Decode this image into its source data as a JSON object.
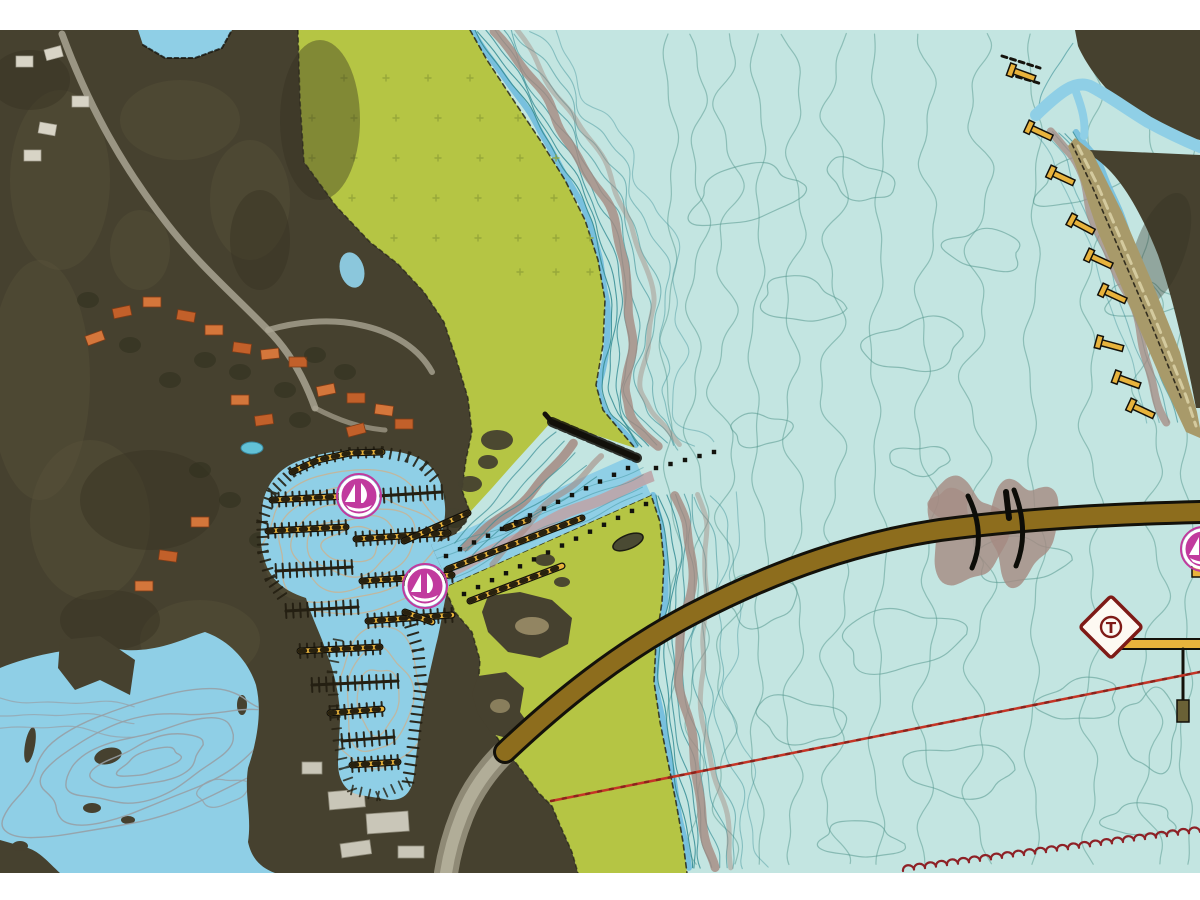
{
  "title": "Marine chart with satellite imagery overlay (marina, channel, bridge and depth contours)",
  "palette": {
    "page_bg": "#ffffff",
    "sat_land": "#46412f",
    "sat_land_light": "#5b553d",
    "sat_land_dark": "#353021",
    "chart_land_green": "#b5c544",
    "land_dot": "#93a238",
    "water_open": "#c3e5e1",
    "water_shallow": "#8fcfe6",
    "water_edge_blue": "#74bedd",
    "contour_teal": "#3a8f96",
    "contour_open": "#55988e",
    "contour_gray": "#97a0a6",
    "contour_tan": "#c3b59b",
    "shoal_mauve": "#a58981",
    "dredge_mauve": "#bca4a8",
    "dock_black": "#241f12",
    "pier_yellow": "#e8b33c",
    "bridge_brown": "#8d6d1d",
    "bridge_outline": "#13110a",
    "beach_tan": "#a89a6a",
    "marina_magenta": "#c13a9e",
    "icon_white": "#ffffff",
    "tower_red": "#7e1a16",
    "hazard_red": "#c53526",
    "cable_dark_red": "#8e2126",
    "road_gray": "#a9a492",
    "roof_orange": "#c2602a",
    "building_white": "#d8d4c6"
  },
  "symbols": {
    "tower_label": "T",
    "marina_facility_icons": 3,
    "legend": [
      {
        "name": "marina-sailboat-icon",
        "meaning": "marina / yacht basin facility"
      },
      {
        "name": "tower-beacon-marker",
        "meaning": "beacon daymark (T)"
      },
      {
        "name": "submarine-cable-line",
        "meaning": "overhead/submarine cable"
      },
      {
        "name": "hazard-boundary-line",
        "meaning": "restricted area / cable boundary"
      },
      {
        "name": "pile-markers",
        "meaning": "dotted pile rows along dredged channel"
      },
      {
        "name": "pier-symbols",
        "meaning": "piers and docks (yellow)"
      },
      {
        "name": "bridge-causeway",
        "meaning": "fixed bridge / causeway"
      },
      {
        "name": "depth-contours",
        "meaning": "bathymetric contour lines"
      }
    ]
  }
}
